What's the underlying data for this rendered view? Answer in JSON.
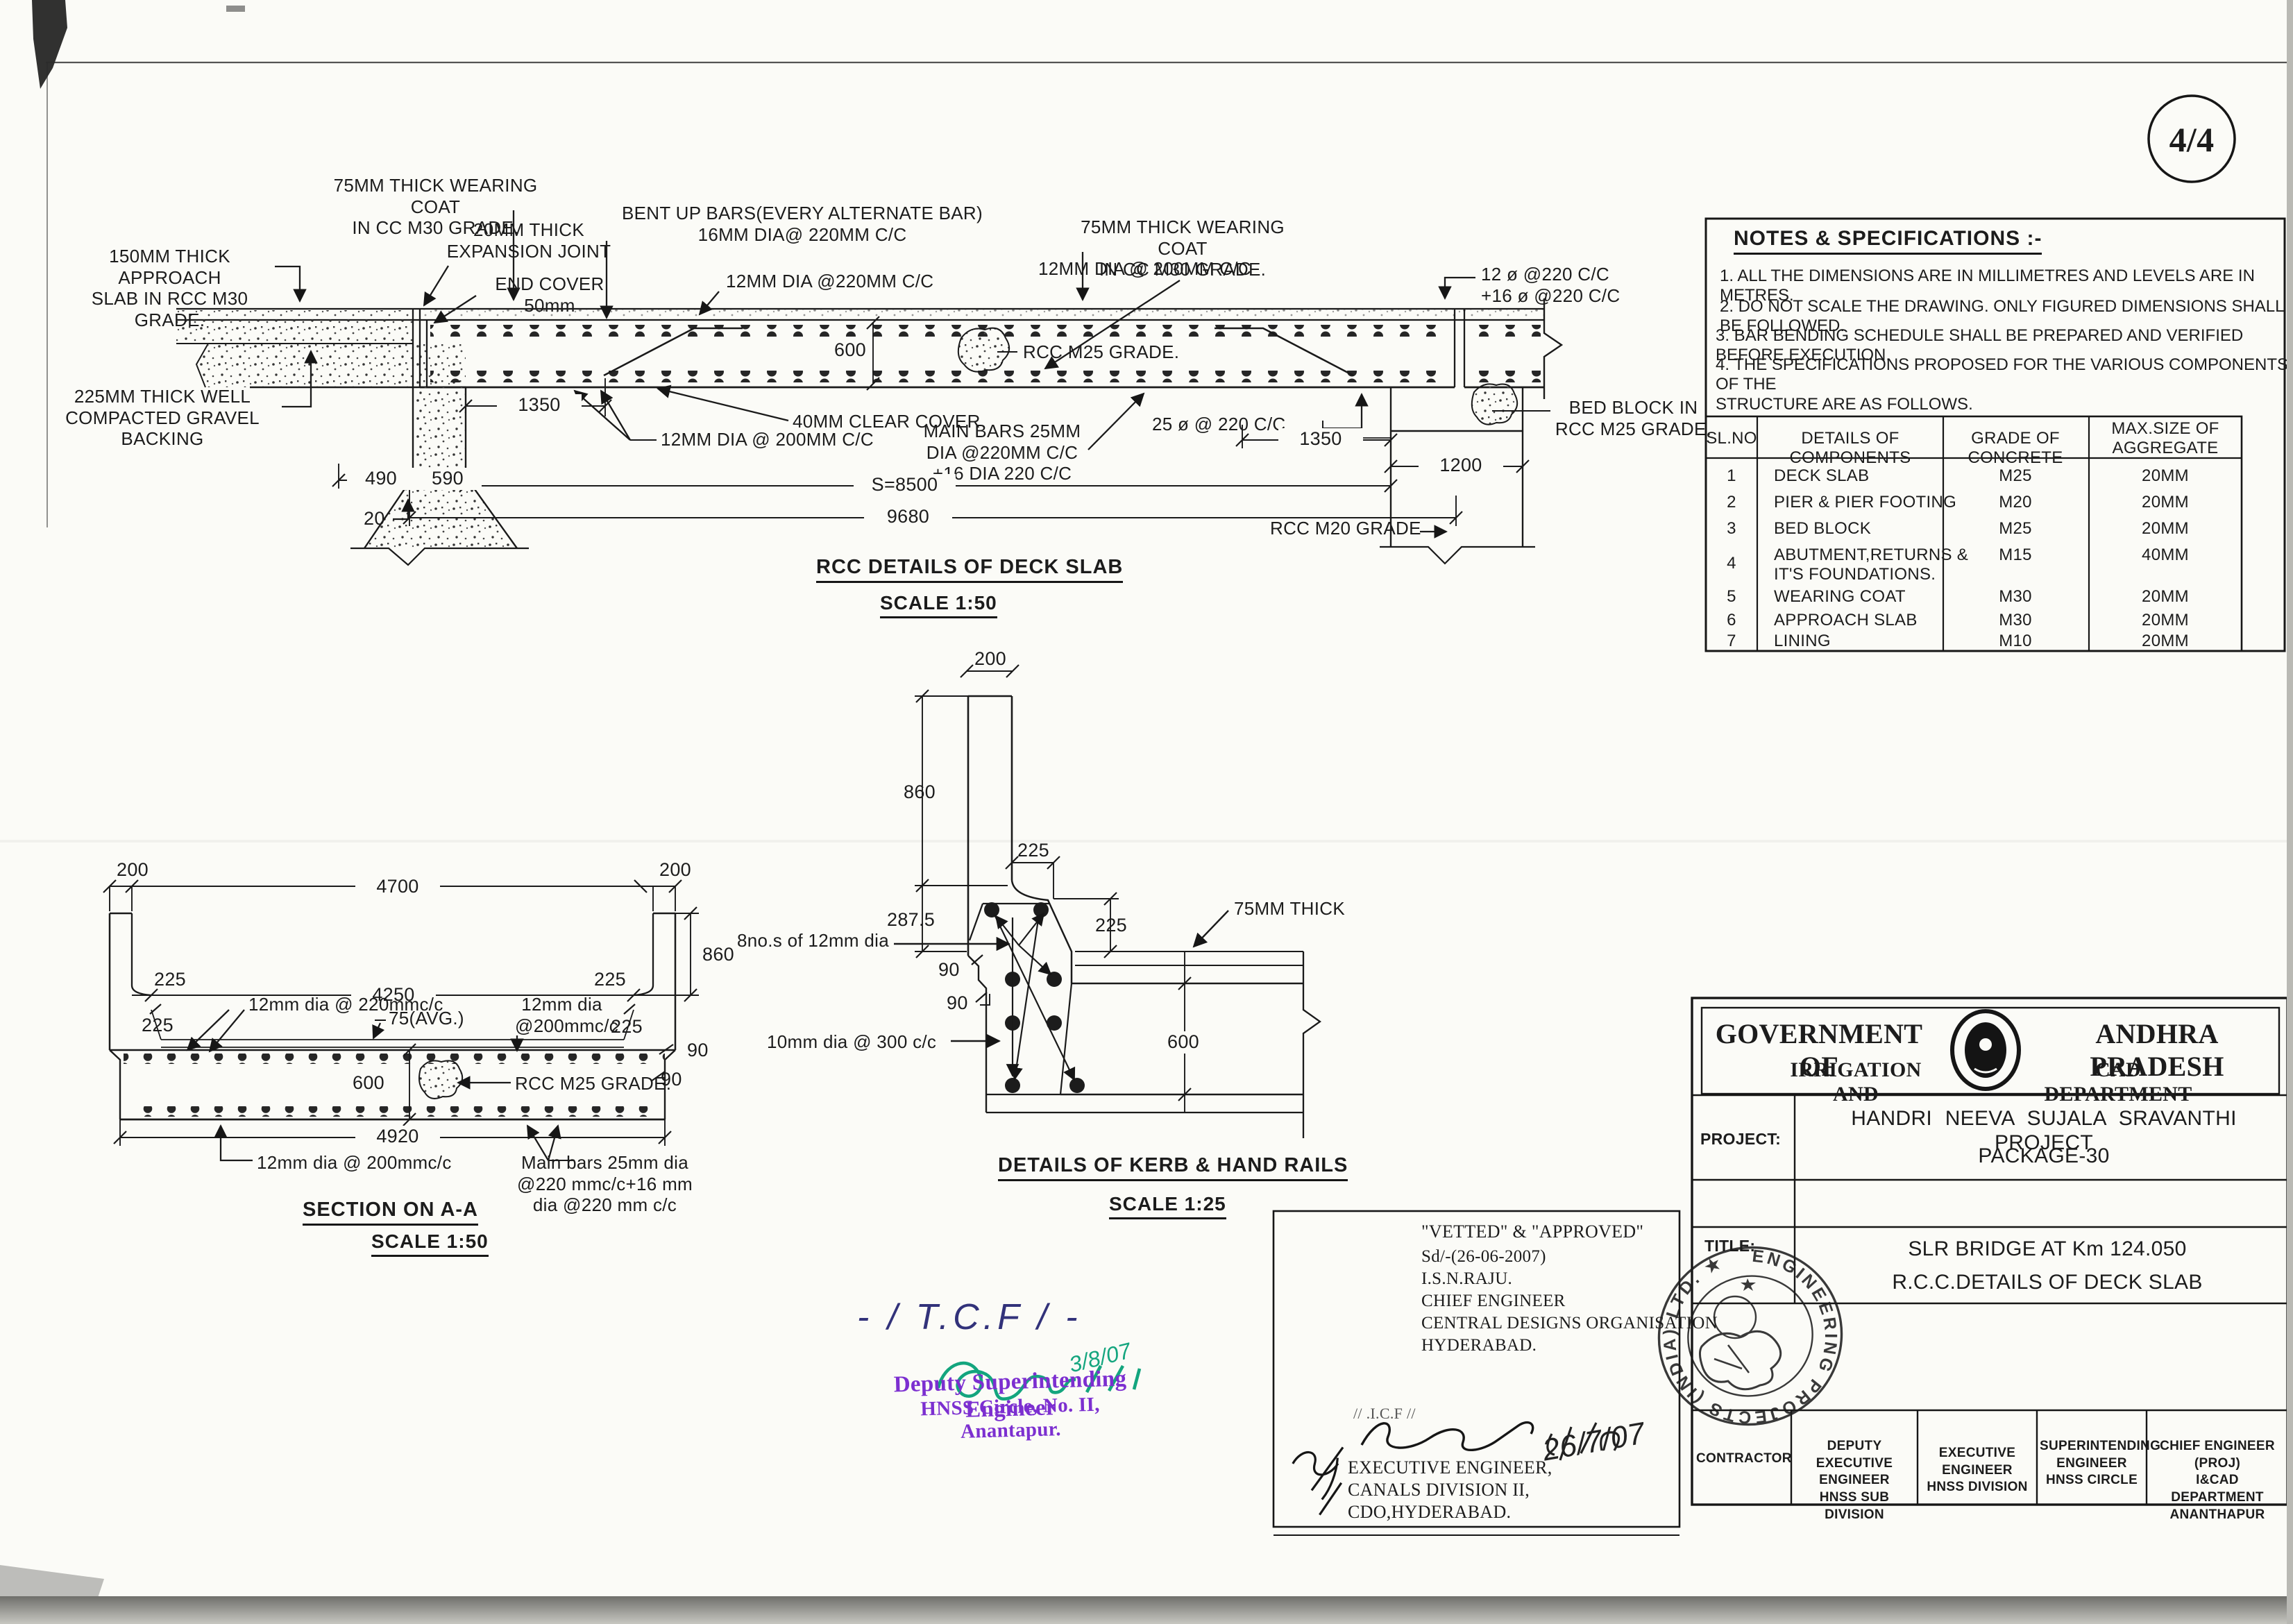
{
  "meta": {
    "page_number": "4/4"
  },
  "deck": {
    "title": "RCC DETAILS OF DECK SLAB",
    "scale": "SCALE 1:50",
    "labels": {
      "wc_left": "75MM THICK WEARING COAT\nIN CC M30 GRADE.",
      "exp_joint": "20MM THICK\nEXPANSION JOINT",
      "approach": "150MM THICK APPROACH\nSLAB IN RCC M30 GRADE.",
      "gravel": "225MM THICK WELL\nCOMPACTED GRAVEL BACKING",
      "bent_up": "BENT UP BARS(EVERY ALTERNATE BAR)\n16MM DIA@ 220MM C/C",
      "end_cover": "END COVER\n50mm",
      "dia12_220": "12MM DIA @220MM C/C",
      "wc_right": "75MM THICK WEARING COAT\nIN CC M30 GRADE.",
      "dia12_200_r": "12MM DIA @ 200MM C/C",
      "bars_12_16": "12 ø @220 C/C\n+16 ø @220 C/C",
      "d600": "600",
      "rcc_m25": "RCC M25 GRADE.",
      "d1350l": "1350",
      "clear_cover": "40MM CLEAR COVER",
      "dia12_200_b": "12MM DIA @ 200MM C/C",
      "main_bars": "MAIN BARS 25MM\nDIA @220MM C/C\n+16 DIA 220 C/C",
      "bars25": "25 ø @ 220 C/C",
      "d1350r": "1350",
      "bed_block": "BED BLOCK IN\nRCC M25 GRADE.",
      "d1200": "1200",
      "s8500": "S=8500",
      "d9680": "9680",
      "rcc_m20": "RCC M20 GRADE",
      "d490": "490",
      "d590": "590",
      "d20": "20"
    }
  },
  "aa": {
    "title": "SECTION ON  A-A",
    "scale": "SCALE 1:50",
    "labels": {
      "d200l": "200",
      "d4700": "4700",
      "d200r": "200",
      "d225tl": "225",
      "d225tr": "225",
      "d4250": "4250",
      "dia12_220": "12mm dia @ 220mmc/c",
      "avg75": "75(AVG.)",
      "dia12_200": "12mm dia\n@200mmc/c",
      "d225l": "225",
      "d225r": "225",
      "d860": "860",
      "d90a": "90",
      "d90b": "90",
      "d600": "600",
      "rcc_m25": "RCC M25 GRADE.",
      "d4920": "4920",
      "dia12_200b": "12mm dia @ 200mmc/c",
      "main_bars": "Main bars 25mm dia\n@220 mmc/c+16 mm\ndia @220 mm c/c"
    }
  },
  "kerb": {
    "title": "DETAILS OF KERB & HAND RAILS",
    "scale": "SCALE 1:25",
    "labels": {
      "d200": "200",
      "d860": "860",
      "d225t": "225",
      "d287": "287.5",
      "bars8": "8no.s of 12mm dia",
      "d225r": "225",
      "thick75": "75MM THICK",
      "d90a": "90",
      "d90b": "90",
      "dia10": "10mm dia @ 300 c/c",
      "d600": "600"
    }
  },
  "notes": {
    "heading": "NOTES & SPECIFICATIONS :-",
    "items": [
      "1.  ALL THE DIMENSIONS ARE IN MILLIMETRES AND LEVELS ARE IN METRES.",
      "2.  DO NOT SCALE THE DRAWING. ONLY FIGURED DIMENSIONS  SHALL BE FOLLOWED.",
      "3. BAR BENDING SCHEDULE SHALL BE PREPARED AND VERIFIED BEFORE EXECUTION.",
      "4. THE SPECIFICATIONS PROPOSED FOR THE VARIOUS COMPONENTS OF THE\nSTRUCTURE ARE AS FOLLOWS."
    ]
  },
  "spec_table": {
    "headers": [
      "SL.NO",
      "DETAILS OF COMPONENTS",
      "GRADE OF CONCRETE",
      "MAX.SIZE OF\nAGGREGATE"
    ],
    "rows": [
      [
        "1",
        "DECK SLAB",
        "M25",
        "20MM"
      ],
      [
        "2",
        "PIER & PIER FOOTING",
        "M20",
        "20MM"
      ],
      [
        "3",
        "BED BLOCK",
        "M25",
        "20MM"
      ],
      [
        "4",
        "ABUTMENT,RETURNS &\nIT'S FOUNDATIONS.",
        "M15",
        "40MM"
      ],
      [
        "5",
        "WEARING COAT",
        "M30",
        "20MM"
      ],
      [
        "6",
        "APPROACH SLAB",
        "M30",
        "20MM"
      ],
      [
        "7",
        "LINING",
        "M10",
        "20MM"
      ]
    ]
  },
  "title_block": {
    "gov_left": "GOVERNMENT OF",
    "gov_right": "ANDHRA PRADESH",
    "dept_left": "IRRIGATION AND",
    "dept_right": "CAD DEPARTMENT",
    "project_label": "PROJECT:",
    "project_line1": "HANDRI  NEEVA  SUJALA  SRAVANTHI  PROJECT",
    "project_line2": "PACKAGE-30",
    "title_label": "TITLE:",
    "title_line1": "SLR BRIDGE AT Km   124.050",
    "title_line2": "R.C.C.DETAILS   OF  DECK  SLAB",
    "signatories": [
      "CONTRACTOR",
      "DEPUTY\nEXECUTIVE ENGINEER\nHNSS SUB DIVISION",
      "EXECUTIVE ENGINEER\nHNSS DIVISION",
      "SUPERINTENDING\nENGINEER\nHNSS CIRCLE",
      "CHIEF ENGINEER (PROJ)\nI&CAD DEPARTMENT\nANANTHAPUR"
    ]
  },
  "vetted": {
    "l1": "\"VETTED\" & \"APPROVED\"",
    "l2": "Sd/-(26-06-2007)",
    "l3": "I.S.N.RAJU.",
    "l4": "CHIEF ENGINEER",
    "l5": "CENTRAL DESIGNS ORGANISATION",
    "l6": "HYDERABAD.",
    "icf": "// .I.C.F //",
    "date": "26/7/07",
    "ee1": "EXECUTIVE ENGINEER,",
    "ee2": "CANALS DIVISION II,",
    "ee3": "CDO,HYDERABAD."
  },
  "hand": {
    "tcf": "- / T.C.F / -",
    "green_date": "3/8/07",
    "purple1": "Deputy Superintending Engineer",
    "purple2": "HNSS Circle, No. II, Anantapur."
  },
  "stamp": {
    "ring_text": "ENGINEERING   PROJECTS  (INDIA)  LTD.  ★"
  }
}
